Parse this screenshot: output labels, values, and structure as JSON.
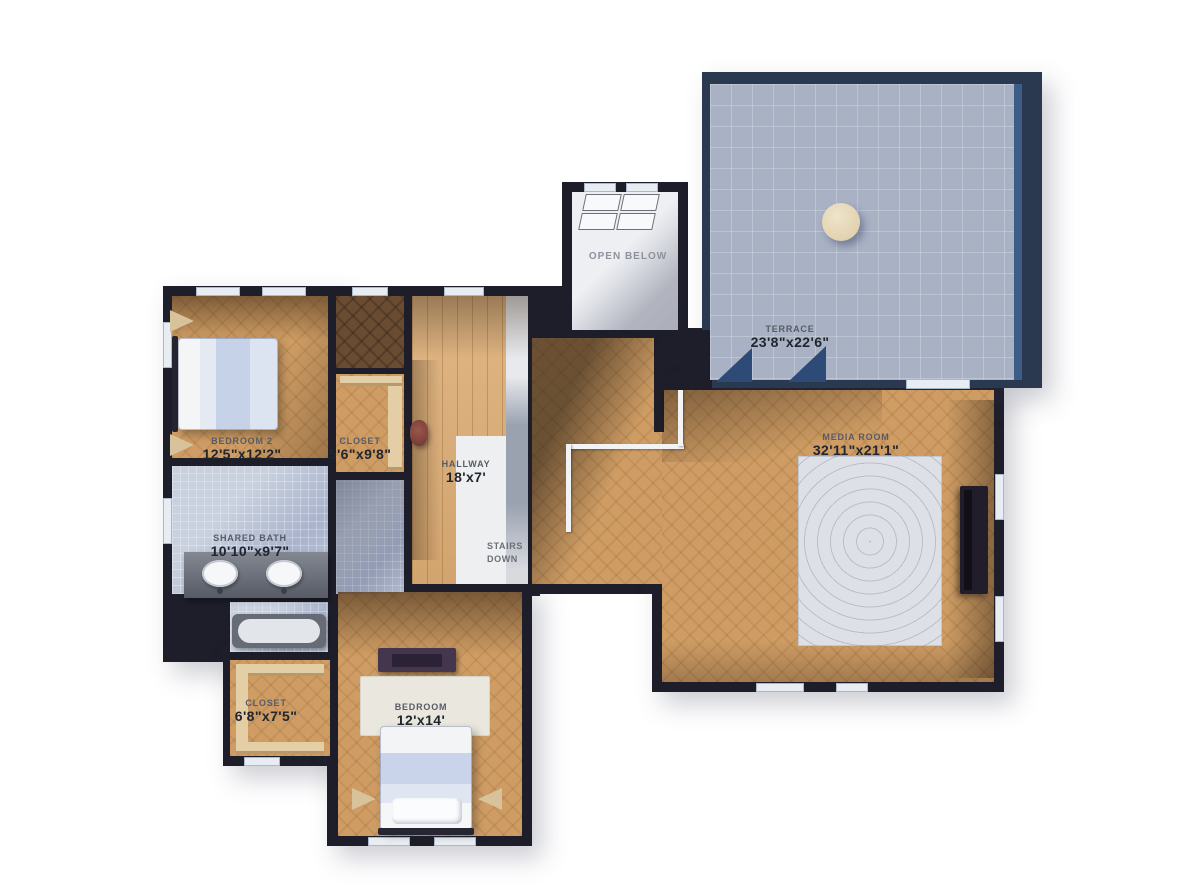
{
  "plan": {
    "type": "second-floor-plan",
    "rooms": [
      {
        "id": "bedroom-2",
        "name": "BEDROOM 2",
        "dims": "12'5\"x12'2\""
      },
      {
        "id": "closet-upper",
        "name": "CLOSET",
        "dims": "5'6\"x9'8\""
      },
      {
        "id": "hallway",
        "name": "HALLWAY",
        "dims": "18'x7'"
      },
      {
        "id": "shared-bath",
        "name": "SHARED BATH",
        "dims": "10'10\"x9'7\""
      },
      {
        "id": "terrace",
        "name": "TERRACE",
        "dims": "23'8\"x22'6\""
      },
      {
        "id": "media-room",
        "name": "MEDIA ROOM",
        "dims": "32'11\"x21'1\""
      },
      {
        "id": "closet-lower",
        "name": "CLOSET",
        "dims": "6'8\"x7'5\""
      },
      {
        "id": "bedroom",
        "name": "BEDROOM",
        "dims": "12'x14'"
      }
    ],
    "annotations": {
      "open_below": "OPEN BELOW",
      "stairs_line1": "STAIRS",
      "stairs_line2": "DOWN"
    },
    "colors": {
      "wall": "#1e1e2b",
      "wood_floor": "#cf9d64",
      "hallway_planks": "#d9ad76",
      "bath_tile": "#b6c0d4",
      "terrace_tile": "#a9b2c4",
      "terrace_parapet": "#2a3850",
      "media_rug": "#dde0e7",
      "recliner": "#23232e",
      "background": "#ffffff"
    },
    "furniture": [
      "bed",
      "bed",
      "vanity-two-sinks",
      "bathtub",
      "dresser",
      "recliner-x6",
      "tv-console",
      "area-rug",
      "round-table",
      "patio-chair-x4",
      "hallway-chair",
      "closet-shelves",
      "plants"
    ]
  }
}
